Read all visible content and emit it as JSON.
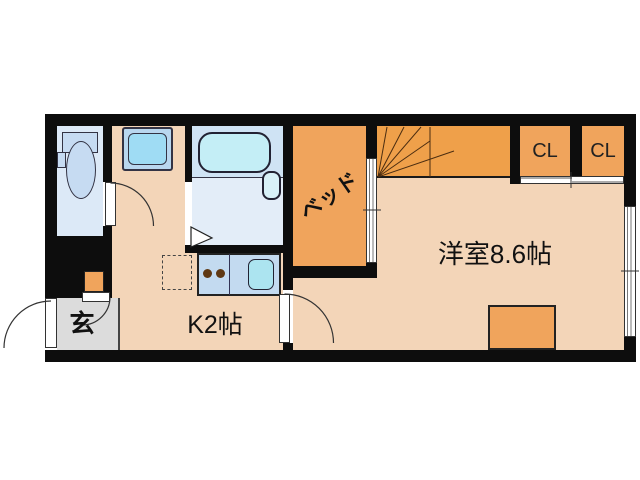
{
  "floorplan": {
    "labels": {
      "bed": "ベッド",
      "main_room": "洋室8.6帖",
      "kitchen": "K2帖",
      "entrance": "玄",
      "closet_left": "CL",
      "closet_right": "CL"
    },
    "colors": {
      "wall": "#0d0d0d",
      "floor_peach": "#f3d5b8",
      "furniture_orange": "#f0a45c",
      "stairs_orange": "#efa04a",
      "wet_area_blue": "#dce9f7",
      "bath_blue": "#cfe3f4",
      "fixture_cyan": "#c4eef6",
      "counter_blue": "#c3daf0",
      "entrance_gray": "#dcdcdc"
    }
  }
}
